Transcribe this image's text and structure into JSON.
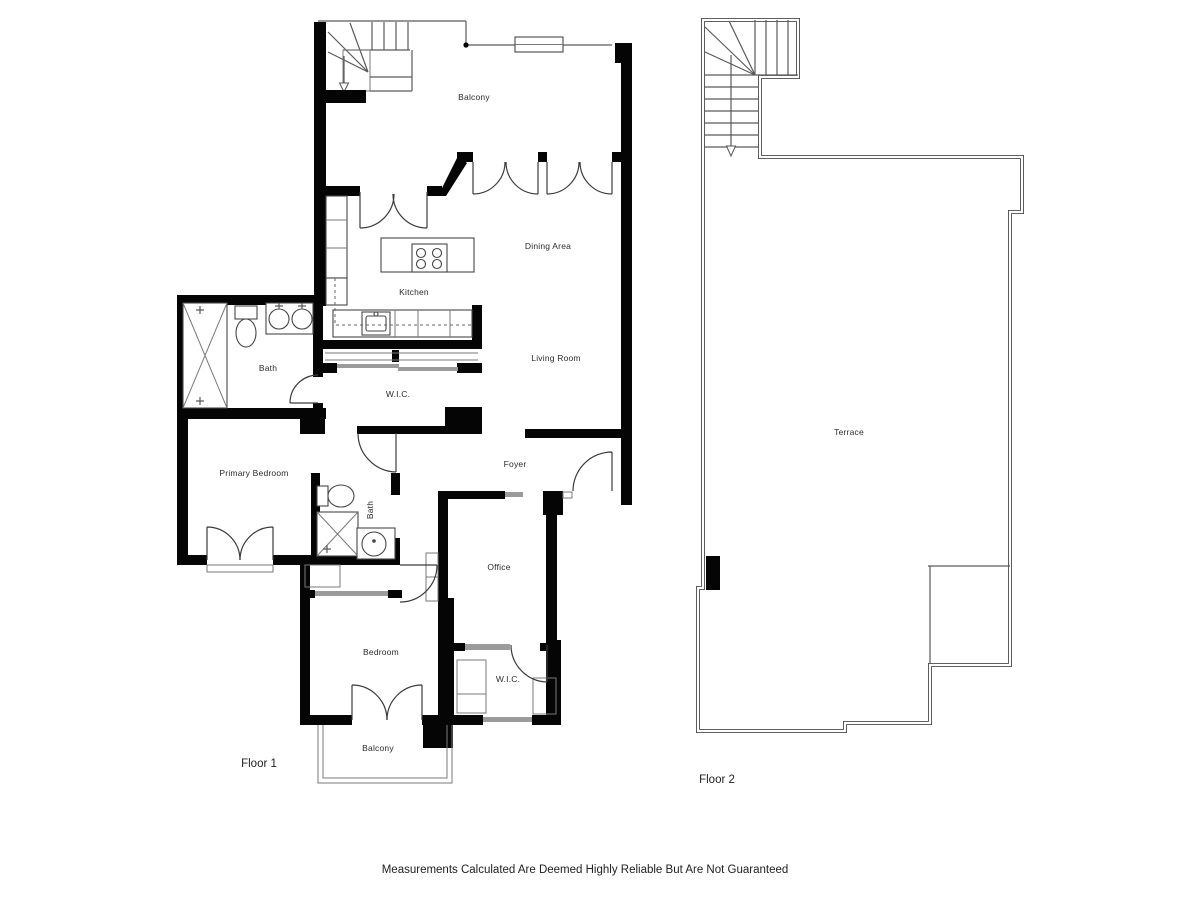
{
  "floor1": {
    "label": "Floor 1",
    "rooms": {
      "balcony_top": "Balcony",
      "kitchen": "Kitchen",
      "dining": "Dining Area",
      "living": "Living Room",
      "wic": "W.I.C.",
      "bath": "Bath",
      "primary_bedroom": "Primary Bedroom",
      "foyer": "Foyer",
      "bath2": "Bath",
      "office": "Office",
      "bedroom": "Bedroom",
      "wic2": "W.I.C.",
      "balcony_bottom": "Balcony"
    }
  },
  "floor2": {
    "label": "Floor 2",
    "rooms": {
      "terrace": "Terrace"
    }
  },
  "disclaimer": "Measurements Calculated Are Deemed Highly Reliable But Are Not Guaranteed"
}
